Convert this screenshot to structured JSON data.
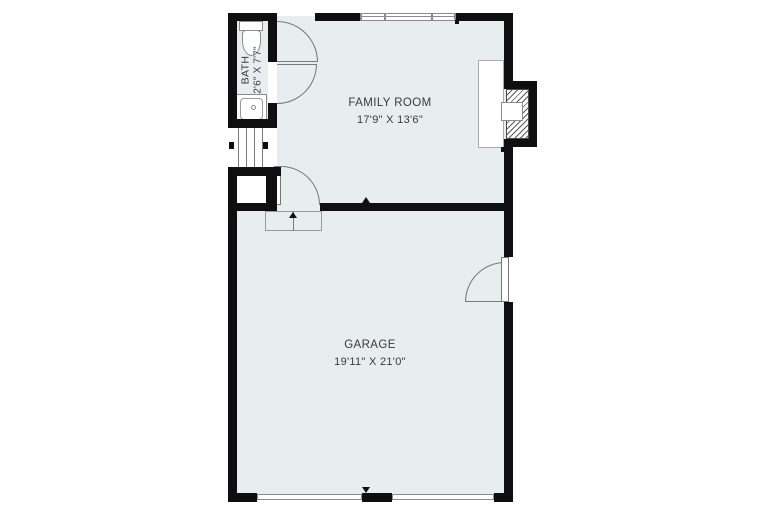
{
  "rooms": {
    "bath": {
      "name": "BATH",
      "dims": "2'6\" X 7'7\""
    },
    "family_room": {
      "name": "FAMILY ROOM",
      "dims": "17'9\" X 13'6\""
    },
    "garage": {
      "name": "GARAGE",
      "dims": "19'11\" X 21'0\""
    }
  },
  "symbols": {
    "toilet": "toilet-symbol",
    "sink": "sink-symbol",
    "fireplace": "fireplace-symbol",
    "stairs": "stairs-symbol",
    "windows": "triple-window-symbol"
  },
  "colors": {
    "wall": "#0f0f0f",
    "floor_fill": "#e8edf0",
    "fixture_line": "#767676",
    "label_text": "#3a3a3a",
    "background": "#ffffff"
  }
}
